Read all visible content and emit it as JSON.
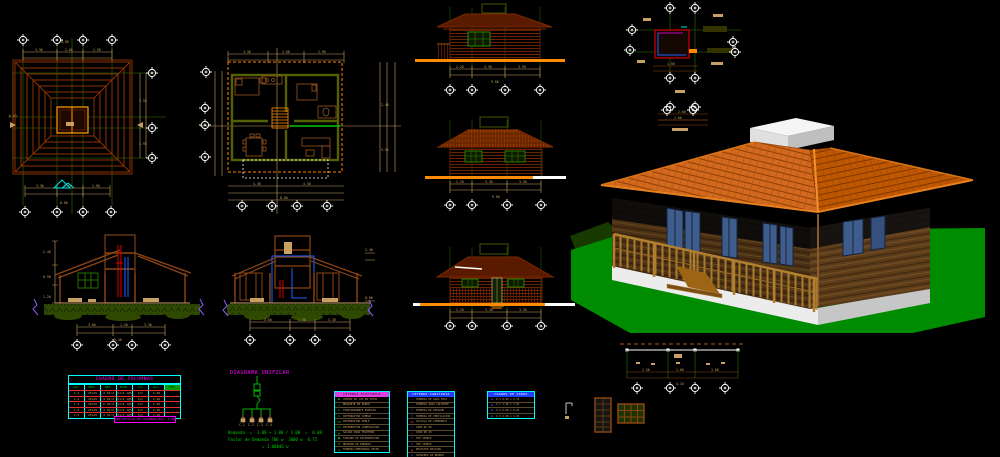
{
  "app": {
    "description": "CAD model space - wooden cabin project drawings"
  },
  "colors": {
    "background": "#000000",
    "grid_bubble": "#FFFFFF",
    "dim_tan": "#C8A064",
    "grid_green": "#225500",
    "roof_line": "#8B3200",
    "accent_orange": "#FF8C00",
    "cyan": "#00E5E5",
    "magenta": "#FF00FF",
    "table_border": "#00FFFF",
    "row_red": "#E03030",
    "detail_blue": "#2060FF",
    "bright_green": "#00C800",
    "lawn_green": "#008C00",
    "roof_tile": "#D2691E",
    "wall_brown": "#4A3014"
  },
  "dims": {
    "d330": "3.30",
    "d260": "2.60",
    "d290": "2.90",
    "d880": "8.80",
    "d360": "3.60",
    "d150": "1.50",
    "d840": "8.40",
    "d220": "2.20",
    "d350": "3.50",
    "d900": "9.00",
    "d240": "2.40",
    "d090": "0.90",
    "d120": "1.20",
    "d650": "6.50",
    "d430": "4.30",
    "d450": "4.50",
    "d100": "1.00",
    "d160": "1.60",
    "d410": "4.10",
    "d355": "3.55",
    "d295": "2.95",
    "d000": "0.00"
  },
  "col_table": {
    "title": "CUADRO DE COLUMNAS",
    "headers": [
      "COL.",
      "SECC.",
      "REF.",
      "ESTR.",
      "S/C",
      "ALT.",
      "OBS."
    ],
    "rows": [
      [
        "C-1",
        "25x25",
        "4 O1/2",
        "O1/4 1@5",
        "S/C",
        "2.40",
        "-"
      ],
      [
        "C-2",
        "25x25",
        "4 O1/2",
        "O1/4 1@5",
        "S/C",
        "2.40",
        "-"
      ],
      [
        "C-3",
        "30x30",
        "6 O1/2",
        "O1/4 1@5",
        "S/C",
        "2.40",
        "-"
      ],
      [
        "C-4",
        "25x25",
        "4 O1/2",
        "O1/4 1@5",
        "S/C",
        "2.40",
        "-"
      ],
      [
        "C-5",
        "25x25",
        "4 O1/2",
        "O1/4 1@5",
        "S/C",
        "2.40",
        "-"
      ]
    ],
    "note": "VER DETALLE DE COLUMNAS ESC. 1/25"
  },
  "electrical": {
    "title": "DIAGRAMA  UNIFILAR",
    "circuits": [
      "C-1",
      "C-2",
      "C-3",
      "C-4"
    ]
  },
  "legend1": {
    "title": "LEYENDA ELECTRICA",
    "rows": [
      {
        "sym": "●",
        "text": "CENTRO DE LUZ EN TECHO"
      },
      {
        "sym": "○",
        "text": "BRAQUETE EN PARED"
      },
      {
        "sym": "⊕",
        "text": "TOMACORRIENTE BIPOLAR"
      },
      {
        "sym": "S",
        "text": "INTERRUPTOR SIMPLE"
      },
      {
        "sym": "S2",
        "text": "INTERRUPTOR DOBLE"
      },
      {
        "sym": "S3",
        "text": "INTERRUPTOR CONMUTACION"
      },
      {
        "sym": "▲",
        "text": "SALIDA PARA TELEFONO"
      },
      {
        "sym": "■",
        "text": "TABLERO DE DISTRIBUCION"
      },
      {
        "sym": "M",
        "text": "MEDIDOR DE ENERGIA"
      },
      {
        "sym": "⊗",
        "text": "TUBERIA EMPOTRADA TECHO"
      }
    ]
  },
  "legend2": {
    "title": "LEYENDA SANITARIA",
    "rows": [
      {
        "sym": "—",
        "text": "TUBERIA DE AGUA FRIA"
      },
      {
        "sym": "—",
        "text": "TUBERIA AGUA CALIENTE"
      },
      {
        "sym": "=",
        "text": "TUBERIA DE DESAGUE"
      },
      {
        "sym": "∥",
        "text": "TUBERIA DE VENTILACION"
      },
      {
        "sym": "⋈",
        "text": "VALVULA DE COMPUERTA"
      },
      {
        "sym": "∟",
        "text": "CODO DE 90"
      },
      {
        "sym": "∠",
        "text": "CODO DE 45"
      },
      {
        "sym": "⊤",
        "text": "TEE SIMPLE"
      },
      {
        "sym": "Y",
        "text": "YEE SIMPLE"
      },
      {
        "sym": "◉",
        "text": "REGISTRO ROSCADO"
      },
      {
        "sym": "◎",
        "text": "SUMIDERO DE BRONCE"
      },
      {
        "sym": "▯",
        "text": "CAJA DE REGISTRO"
      }
    ]
  },
  "openings": {
    "title": "CUADRO DE VANOS",
    "rows": [
      {
        "sym": "▮",
        "text": "P-1  0.90 x 2.10"
      },
      {
        "sym": "▮",
        "text": "V-1  1.20 x 1.00"
      },
      {
        "sym": "▮",
        "text": "V-2  0.60 x 0.60"
      },
      {
        "sym": "▮",
        "text": "V-3  2.40 x 1.00"
      }
    ]
  },
  "calc": {
    "l1": "Demanda  =  1.08 + 1.08 / 1.08  =  0.08",
    "l2": "Factor de Demanda 700 w  3000 w  0.75",
    "l3": "= 1.08846 w"
  }
}
